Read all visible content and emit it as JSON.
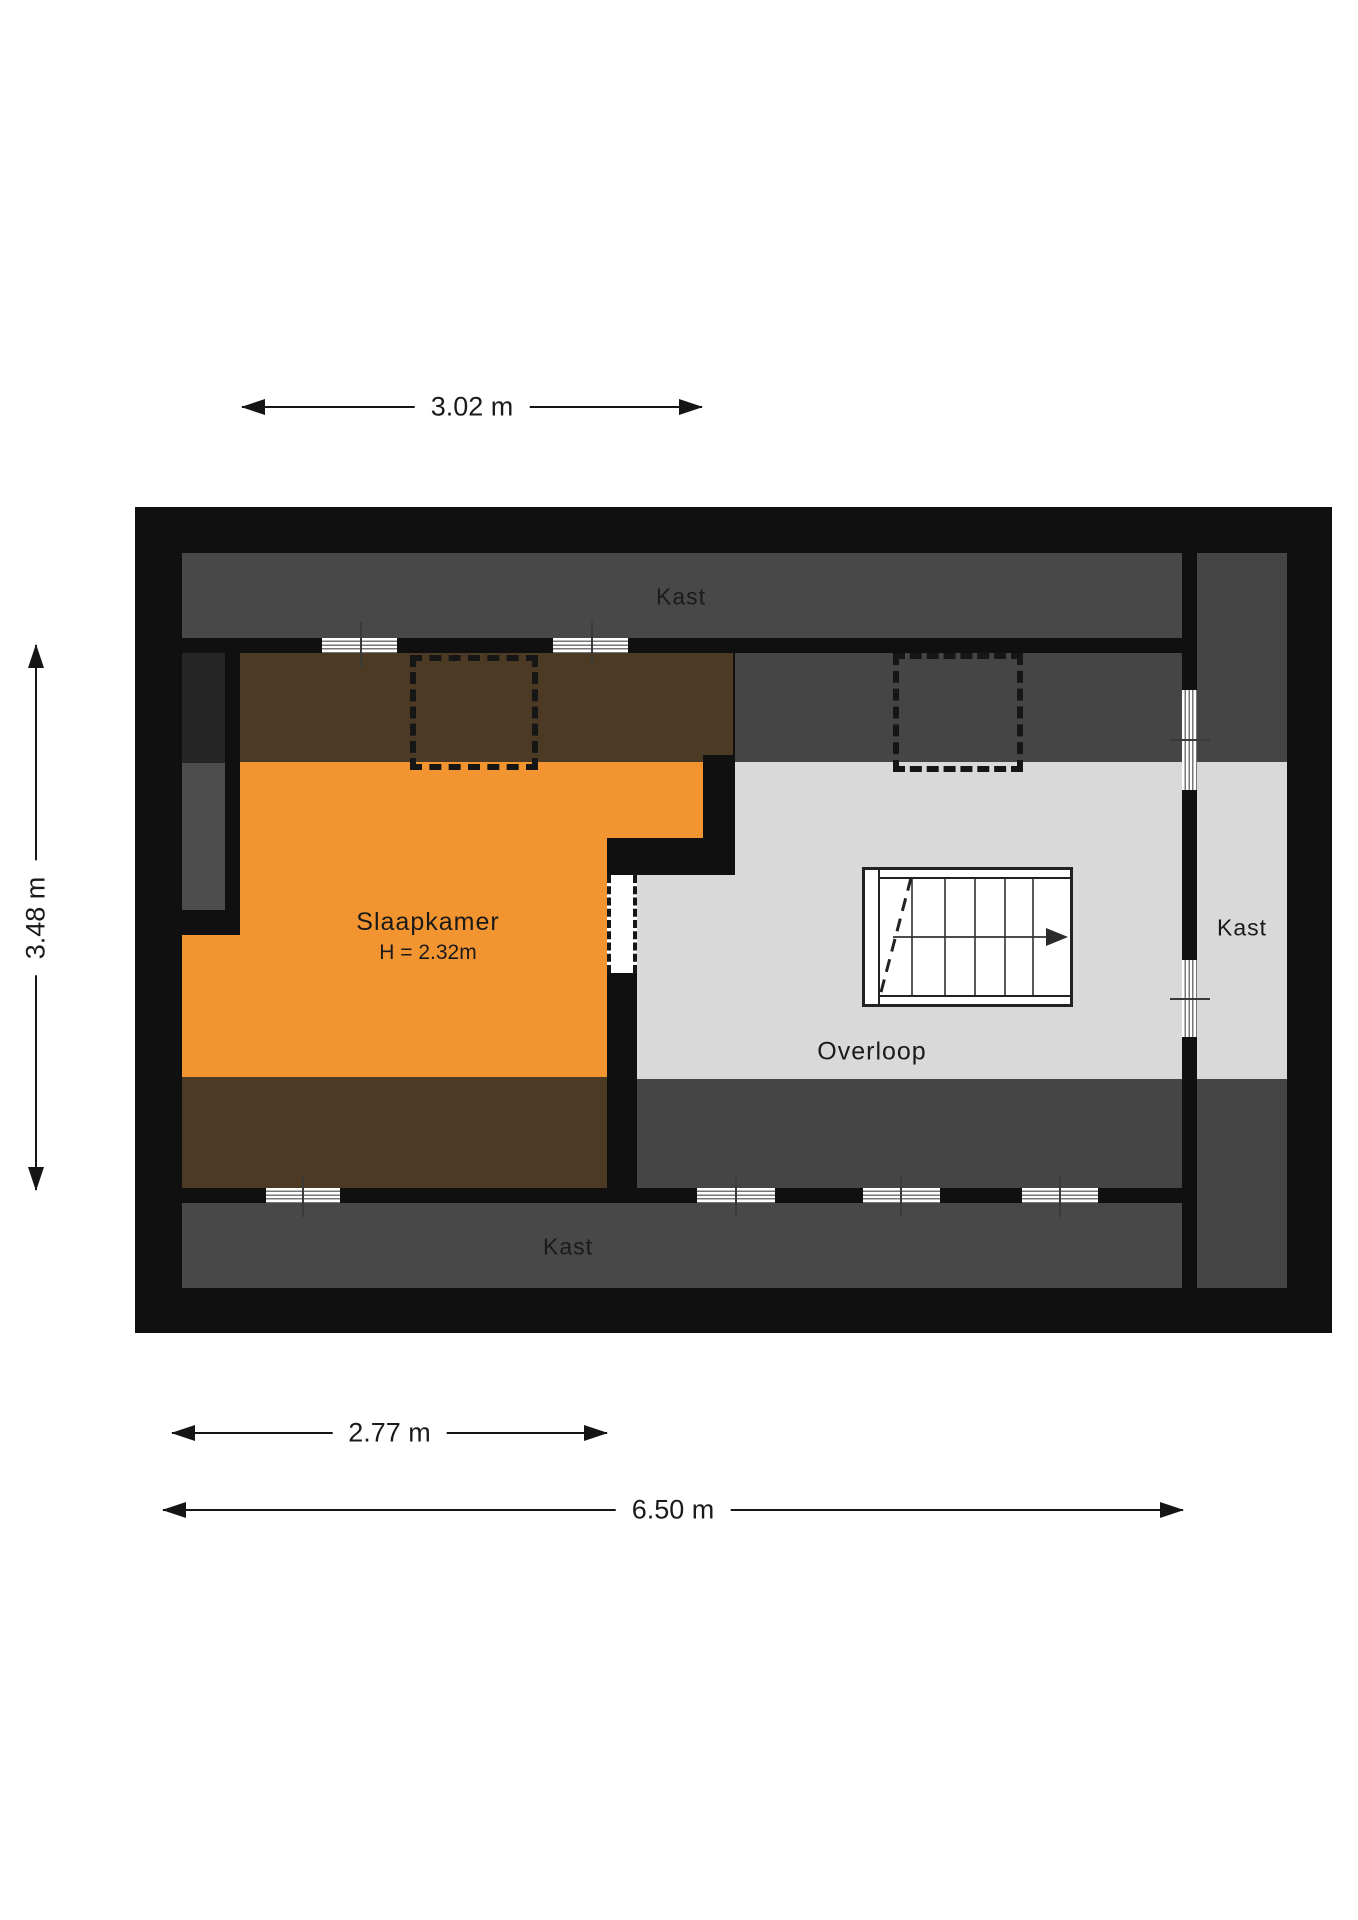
{
  "floorplan": {
    "labels": {
      "closet_top": "Kast",
      "closet_bottom": "Kast",
      "closet_right": "Kast",
      "bedroom": "Slaapkamer",
      "bedroom_height": "H = 2.32m",
      "landing": "Overloop"
    },
    "dimensions": {
      "top_width": "3.02 m",
      "left_height": "3.48 m",
      "bottom_bedroom_width": "2.77 m",
      "bottom_total_width": "6.50 m"
    },
    "colors": {
      "background": "#ffffff",
      "wall": "#101010",
      "closet_strip": "#484848",
      "sloped_band": "#454545",
      "knee_column": "#4d4d4d",
      "dark_block": "#262626",
      "bedroom": "#f2942f",
      "attic_floor": "#4c3a25",
      "landing": "#d9d9d9",
      "window_line": "#777777",
      "text": "#1a1a1a"
    }
  }
}
